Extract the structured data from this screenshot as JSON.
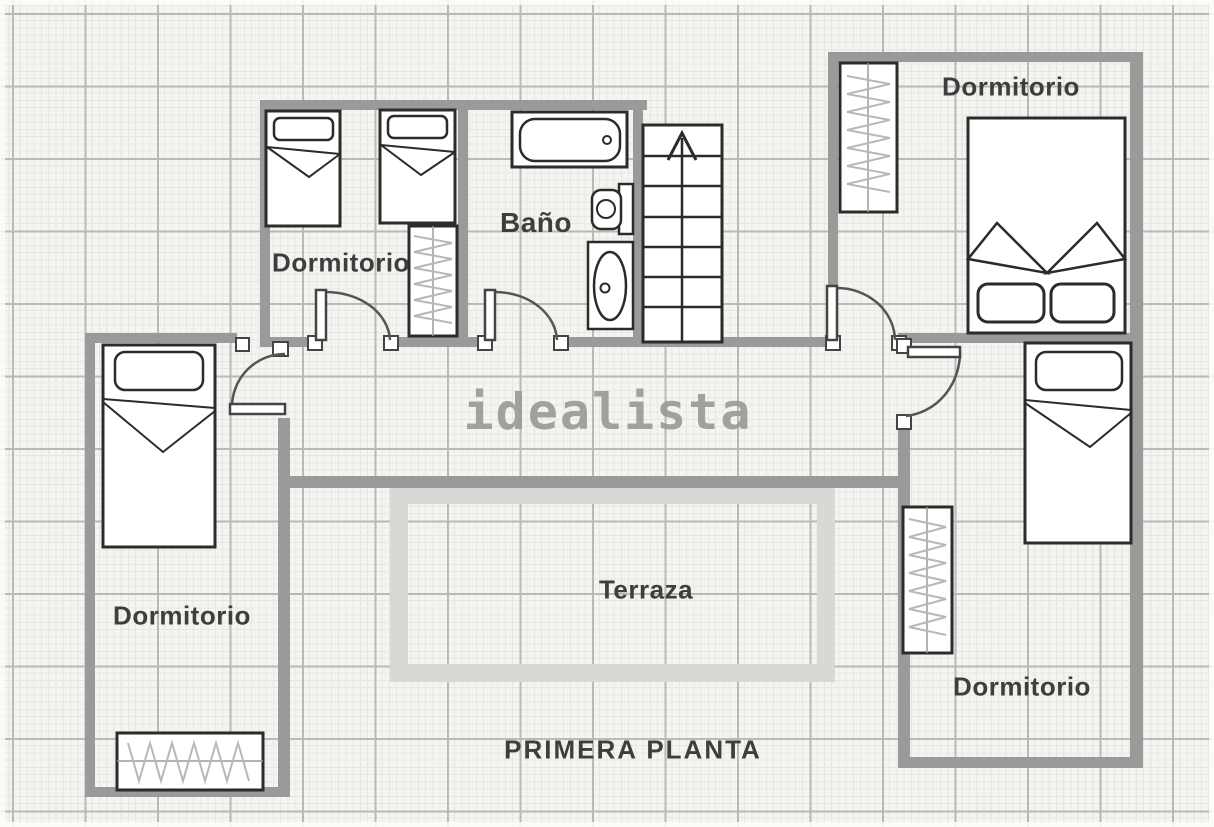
{
  "title": {
    "floor_label": "PRIMERA PLANTA"
  },
  "watermark": "idealista",
  "labels": {
    "bedroom_top_middle": "Dormitorio",
    "bathroom": "Baño",
    "bedroom_top_right": "Dormitorio",
    "bedroom_left": "Dormitorio",
    "bedroom_right": "Dormitorio",
    "terrace": "Terraza"
  },
  "rooms": [
    {
      "name": "bedroom-top-middle",
      "label": "Dormitorio",
      "furniture": [
        "single-bed",
        "single-bed",
        "wardrobe",
        "door"
      ]
    },
    {
      "name": "bathroom",
      "label": "Baño",
      "furniture": [
        "bathtub",
        "toilet",
        "sink",
        "door"
      ]
    },
    {
      "name": "staircase",
      "label": "",
      "furniture": [
        "stairs-up-arrow"
      ]
    },
    {
      "name": "bedroom-top-right",
      "label": "Dormitorio",
      "furniture": [
        "double-bed",
        "wardrobe",
        "door"
      ]
    },
    {
      "name": "bedroom-left",
      "label": "Dormitorio",
      "furniture": [
        "single-bed",
        "wardrobe",
        "door"
      ]
    },
    {
      "name": "bedroom-right",
      "label": "Dormitorio",
      "furniture": [
        "single-bed",
        "wardrobe",
        "door"
      ]
    },
    {
      "name": "terrace",
      "label": "Terraza",
      "furniture": []
    }
  ],
  "colors": {
    "paper": "#f4f4f1",
    "grid_minor": "#e7e7e2",
    "grid_major": "#b9b9b5",
    "wall": "#9a9a9a",
    "terrace_border": "#d8d8d4",
    "outline": "#2b2b2b",
    "label_text": "#3e3e3e",
    "watermark": "#9a9a9a"
  }
}
